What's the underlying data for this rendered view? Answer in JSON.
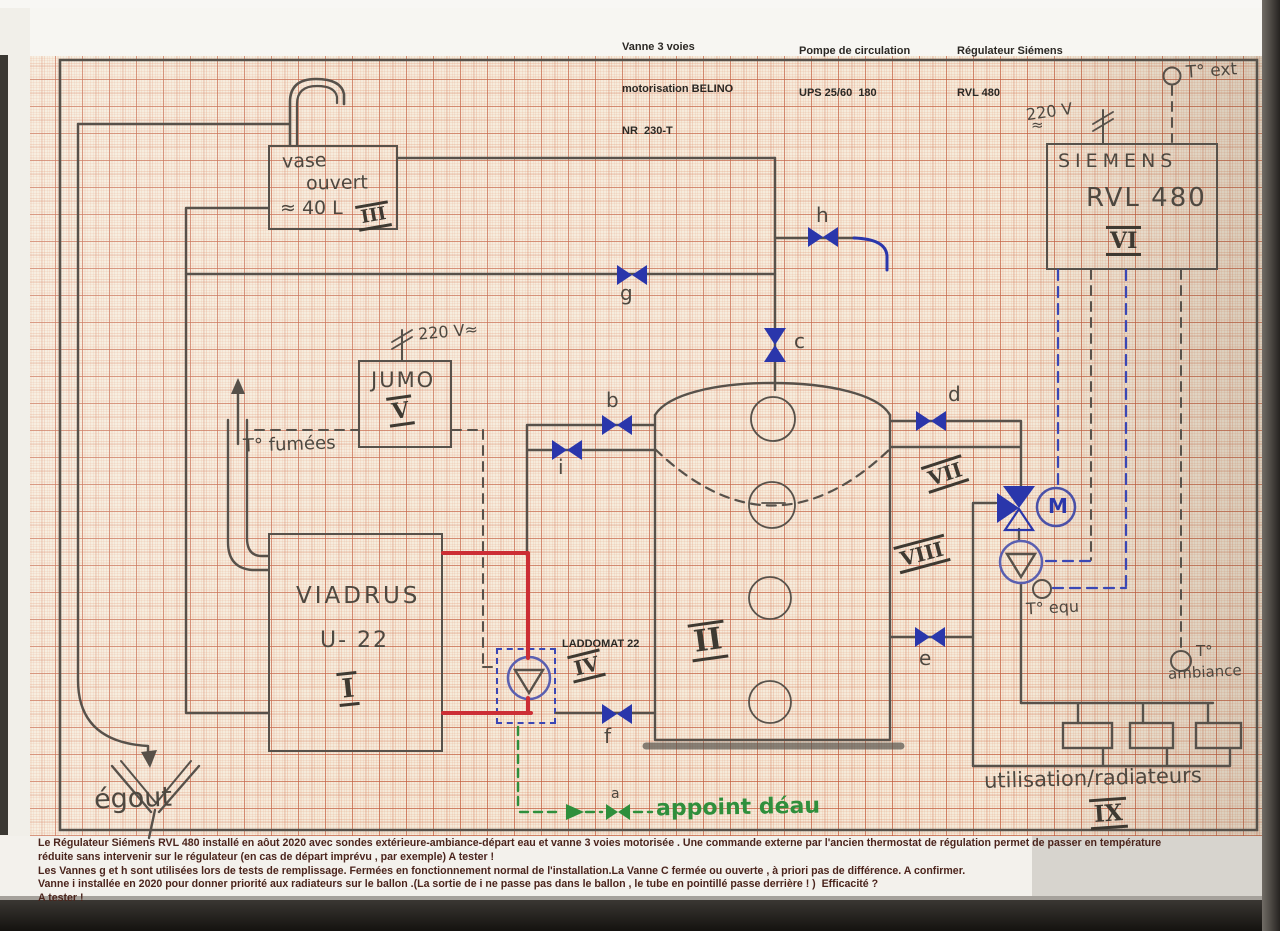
{
  "annotations_top": [
    {
      "lines": [
        "Vanne 3 voies",
        "motorisation BELINO",
        "NR  230-T"
      ]
    },
    {
      "lines": [
        "Pompe de circulation",
        "UPS 25/60  180"
      ]
    },
    {
      "lines": [
        "Régulateur Siémens",
        "RVL 480"
      ]
    }
  ],
  "caption_lines": [
    "Le Régulateur Siémens RVL 480 installé en aôut 2020 avec sondes extérieure-ambiance-départ eau et vanne 3 voies motorisée . Une commande externe par l'ancien thermostat de régulation permet de passer en température",
    "réduite sans intervenir sur le régulateur (en cas de départ imprévu , par exemple) A tester !",
    "Les Vannes g et h sont utilisées lors de tests de remplissage. Fermées en fonctionnement normal de l'installation.La Vanne C fermée ou ouverte , à priori pas de différence. A confirmer.",
    "Vanne i installée en 2020 pour donner priorité aux radiateurs sur le ballon .(La sortie de i ne passe pas dans le ballon , le tube en pointillé passe derrière ! )  Efficacité ?",
    "A tester !"
  ],
  "components": {
    "vase": {
      "l1": "vase",
      "l2": "ouvert",
      "l3": "≈ 40 L",
      "numeral": "III"
    },
    "viadrus": {
      "brand": "VIADRUS",
      "model": "U- 22",
      "numeral": "I"
    },
    "tank": {
      "numeral": "II"
    },
    "laddomat": {
      "label": "LADDOMAT 22",
      "numeral": "IV"
    },
    "jumo": {
      "name": "JUMO",
      "numeral": "V",
      "power": "220 V≈"
    },
    "siemens": {
      "brand": "SIEMENS",
      "model": "RVL 480",
      "numeral": "VI",
      "power": "220 V",
      "power_wave": "≈"
    },
    "sections": {
      "vii": "VII",
      "viii": "VIII"
    },
    "radiators": {
      "label": "utilisation/radiateurs",
      "numeral": "IX"
    },
    "motor": "M"
  },
  "sensors": {
    "t_ext": "T° ext",
    "t_fumees": "T° fumées",
    "t_equ": "T° equ",
    "t_amb_1": "T°",
    "t_amb_2": "ambiance"
  },
  "valves": {
    "a": "a",
    "b": "b",
    "c": "c",
    "d": "d",
    "e": "e",
    "f": "f",
    "g": "g",
    "h": "h",
    "i": "i"
  },
  "labels": {
    "egout": "égout",
    "appoint": "appoint déau"
  },
  "colors": {
    "paper": "#f5ead9",
    "grid_line": "#d98a64",
    "pencil": "#57514a",
    "ink_blue": "#2a36ab",
    "pipe_red": "#cc2e35",
    "water_green": "#2f8f3c"
  }
}
